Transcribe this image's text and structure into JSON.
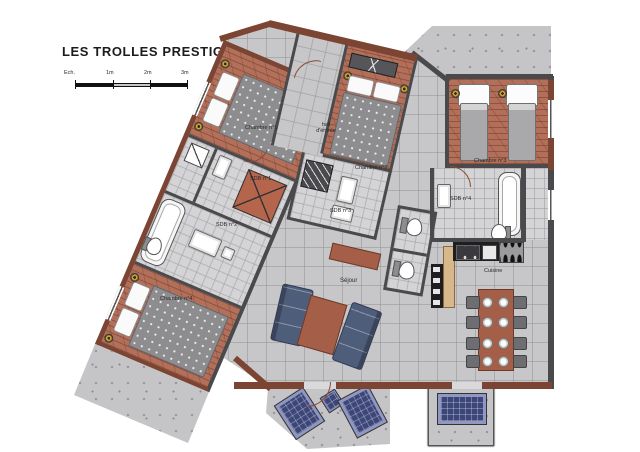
{
  "title": "LES TROLLES PRESTIGE N°3",
  "scale_bar": {
    "label": "Ech.",
    "marks": [
      "1m",
      "2m",
      "3m"
    ]
  },
  "rooms": {
    "chambre1": {
      "label": "Chambre n°1"
    },
    "chambre2": {
      "label": "Chambre n°2"
    },
    "chambre3": {
      "label": "Chambre n°3"
    },
    "chambre4": {
      "label": "Chambre n°4"
    },
    "sdb1": {
      "label": "SDB n°1"
    },
    "sdb2": {
      "label": "SDB n°2"
    },
    "sdb3": {
      "label": "SDB n°3"
    },
    "sdb4": {
      "label": "SDB n°4"
    },
    "hall": {
      "label": "hall d'entrée"
    },
    "sejour": {
      "label": "Séjour"
    },
    "cuisine": {
      "label": "Cuisine"
    }
  },
  "colors": {
    "wood_floor": "#b2705a",
    "exterior_wall": "#7b4433",
    "interior_wall": "#4a4a4c",
    "tile_floor": "#c7c7c9",
    "terrace": "#c5c5c7",
    "sofa": "#4e5d7a",
    "lounge_chair": "#3c4678",
    "wood_furniture": "#a55f48",
    "duvet": "#8d8d90",
    "kitchen_counter": "#d8b88a"
  }
}
